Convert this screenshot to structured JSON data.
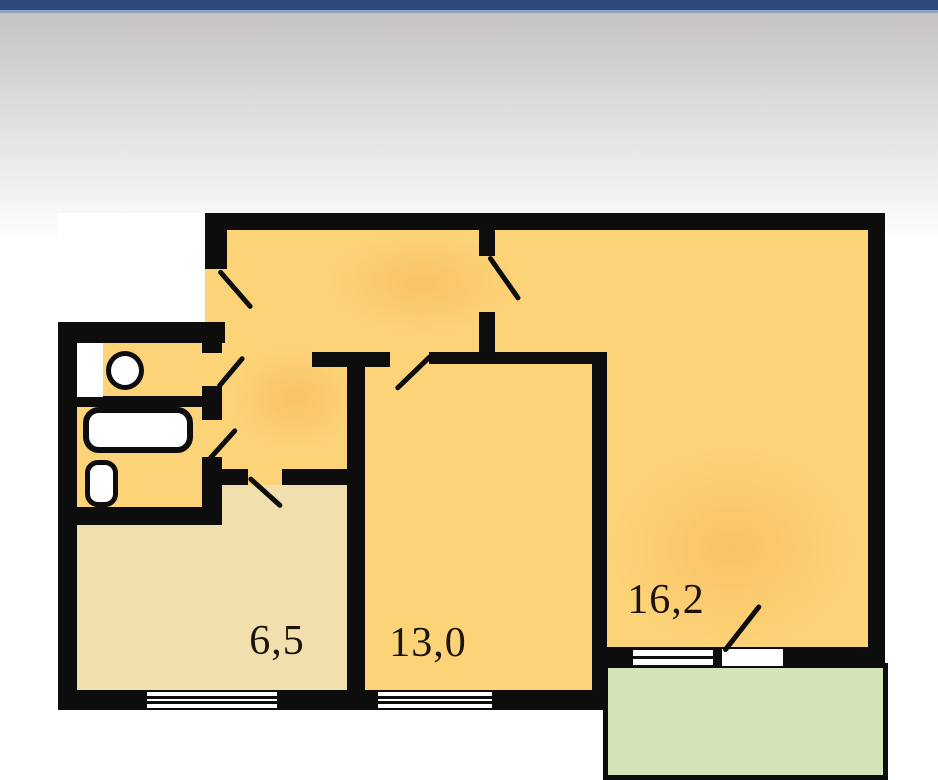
{
  "header": {
    "bar_color": "#2e4a7b",
    "bar_highlight": "#8fa2c2"
  },
  "colors": {
    "wall": "#0d0d0d",
    "room-yellow": "#fcd377",
    "room-beige": "#f2dfae",
    "balcony-green": "#d2e4b8",
    "shade-orange": "#f6b457",
    "page-top-gray": "#c7c3c3",
    "label-ink": "#1c1408",
    "bar-navy": "#2e4a7b",
    "bar-highlight": "#8fa2c2"
  },
  "floorplan": {
    "type": "apartment-floor-plan",
    "rooms": [
      {
        "name": "small-room",
        "area_label": "6,5"
      },
      {
        "name": "middle-room",
        "area_label": "13,0"
      },
      {
        "name": "living-room",
        "area_label": "16,2"
      }
    ],
    "unlabeled_spaces": [
      "hallway",
      "wc",
      "bathroom",
      "balcony"
    ],
    "fixtures": [
      "sink",
      "toilet",
      "bathtub",
      "washbasin"
    ],
    "windows_count": 3,
    "door_swings_count": 7
  }
}
